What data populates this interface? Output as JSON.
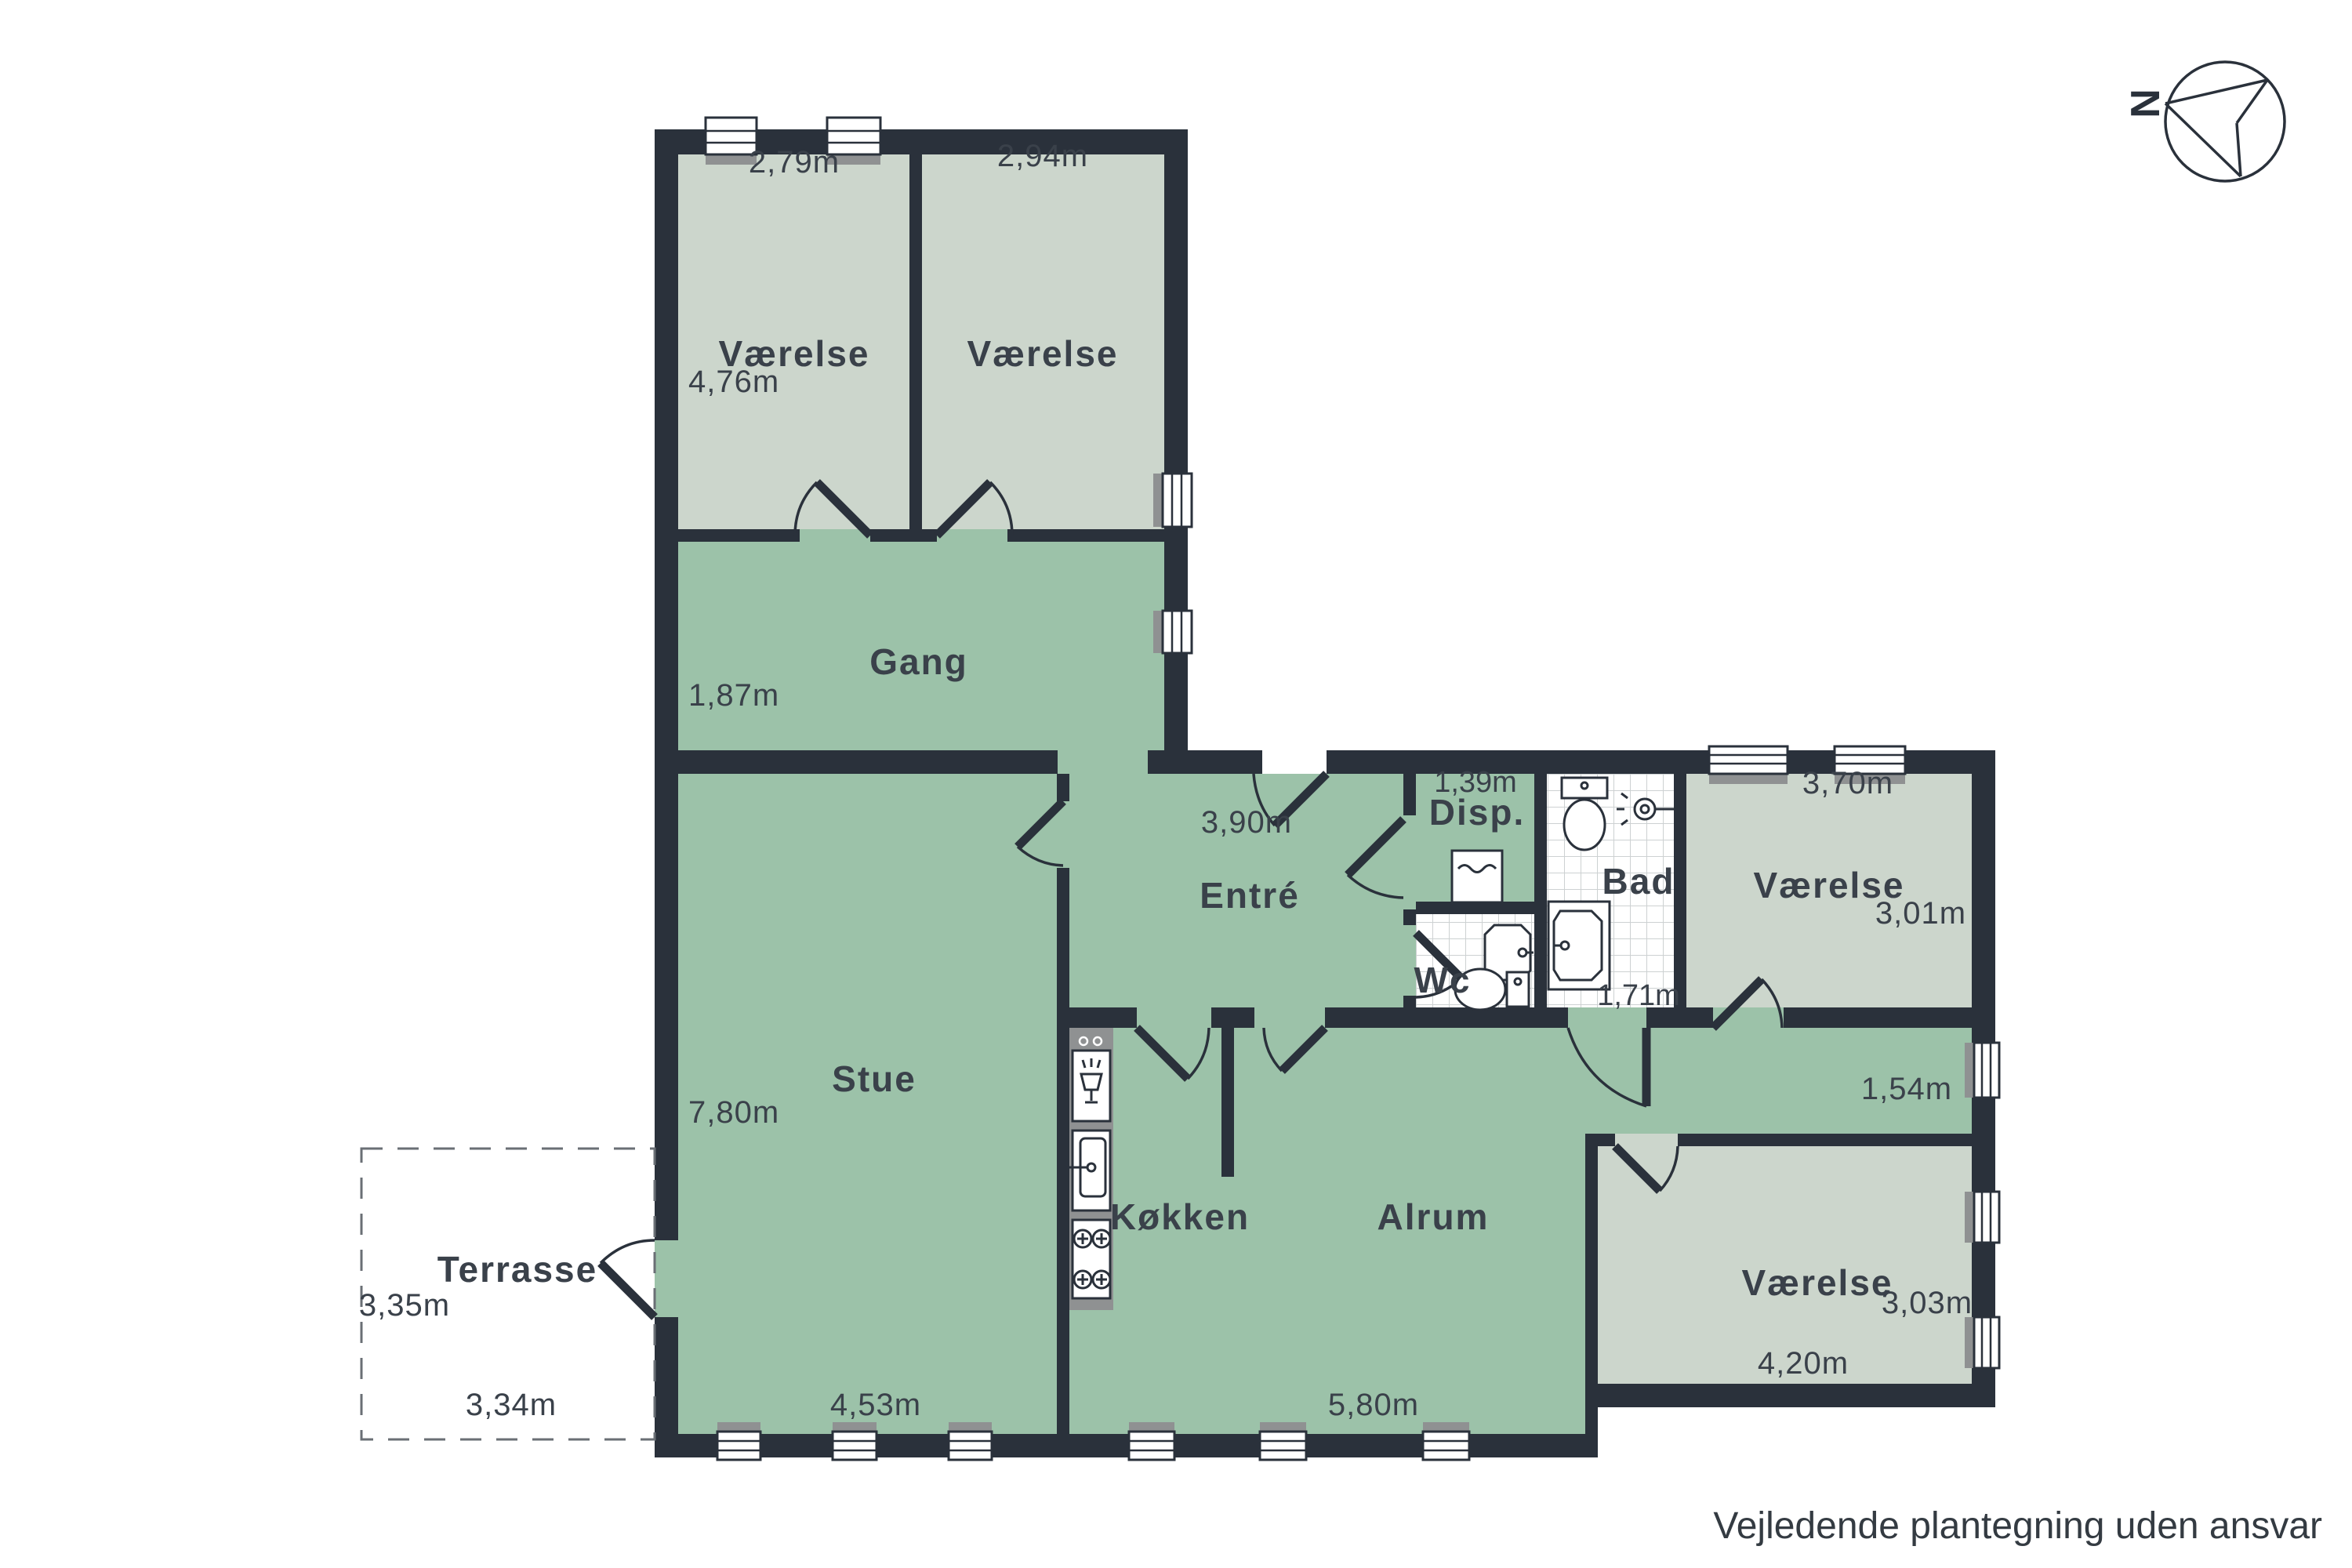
{
  "rooms": {
    "vaerelse_nw": {
      "label": "Værelse",
      "width": "2,79m",
      "height": "4,76m"
    },
    "vaerelse_n": {
      "label": "Værelse",
      "width": "2,94m"
    },
    "gang": {
      "label": "Gang",
      "height": "1,87m"
    },
    "entre": {
      "label": "Entré",
      "width": "3,90m"
    },
    "disp": {
      "label": "Disp.",
      "width": "1,39m"
    },
    "wc": {
      "label": "Wc"
    },
    "bad": {
      "label": "Bad",
      "width": "1,71m"
    },
    "vaerelse_e": {
      "label": "Værelse",
      "width": "3,70m",
      "height": "3,01m"
    },
    "stue": {
      "label": "Stue",
      "height": "7,80m",
      "width": "4,53m"
    },
    "koekken": {
      "label": "Køkken"
    },
    "alrum": {
      "label": "Alrum",
      "width": "5,80m",
      "corridor_width": "1,54m"
    },
    "vaerelse_se": {
      "label": "Værelse",
      "width": "4,20m",
      "height": "3,03m"
    },
    "terrasse": {
      "label": "Terrasse",
      "depth": "3,35m",
      "width": "3,34m"
    }
  },
  "compass": {
    "label": "N"
  },
  "footer": {
    "disclaimer": "Vejledende plantegning uden ansvar"
  },
  "colors": {
    "wall": "#2a313b",
    "floor_main": "#9cc2a9",
    "floor_room": "#ccd6cc",
    "sill": "#8f9192",
    "text": "#3a414a"
  }
}
